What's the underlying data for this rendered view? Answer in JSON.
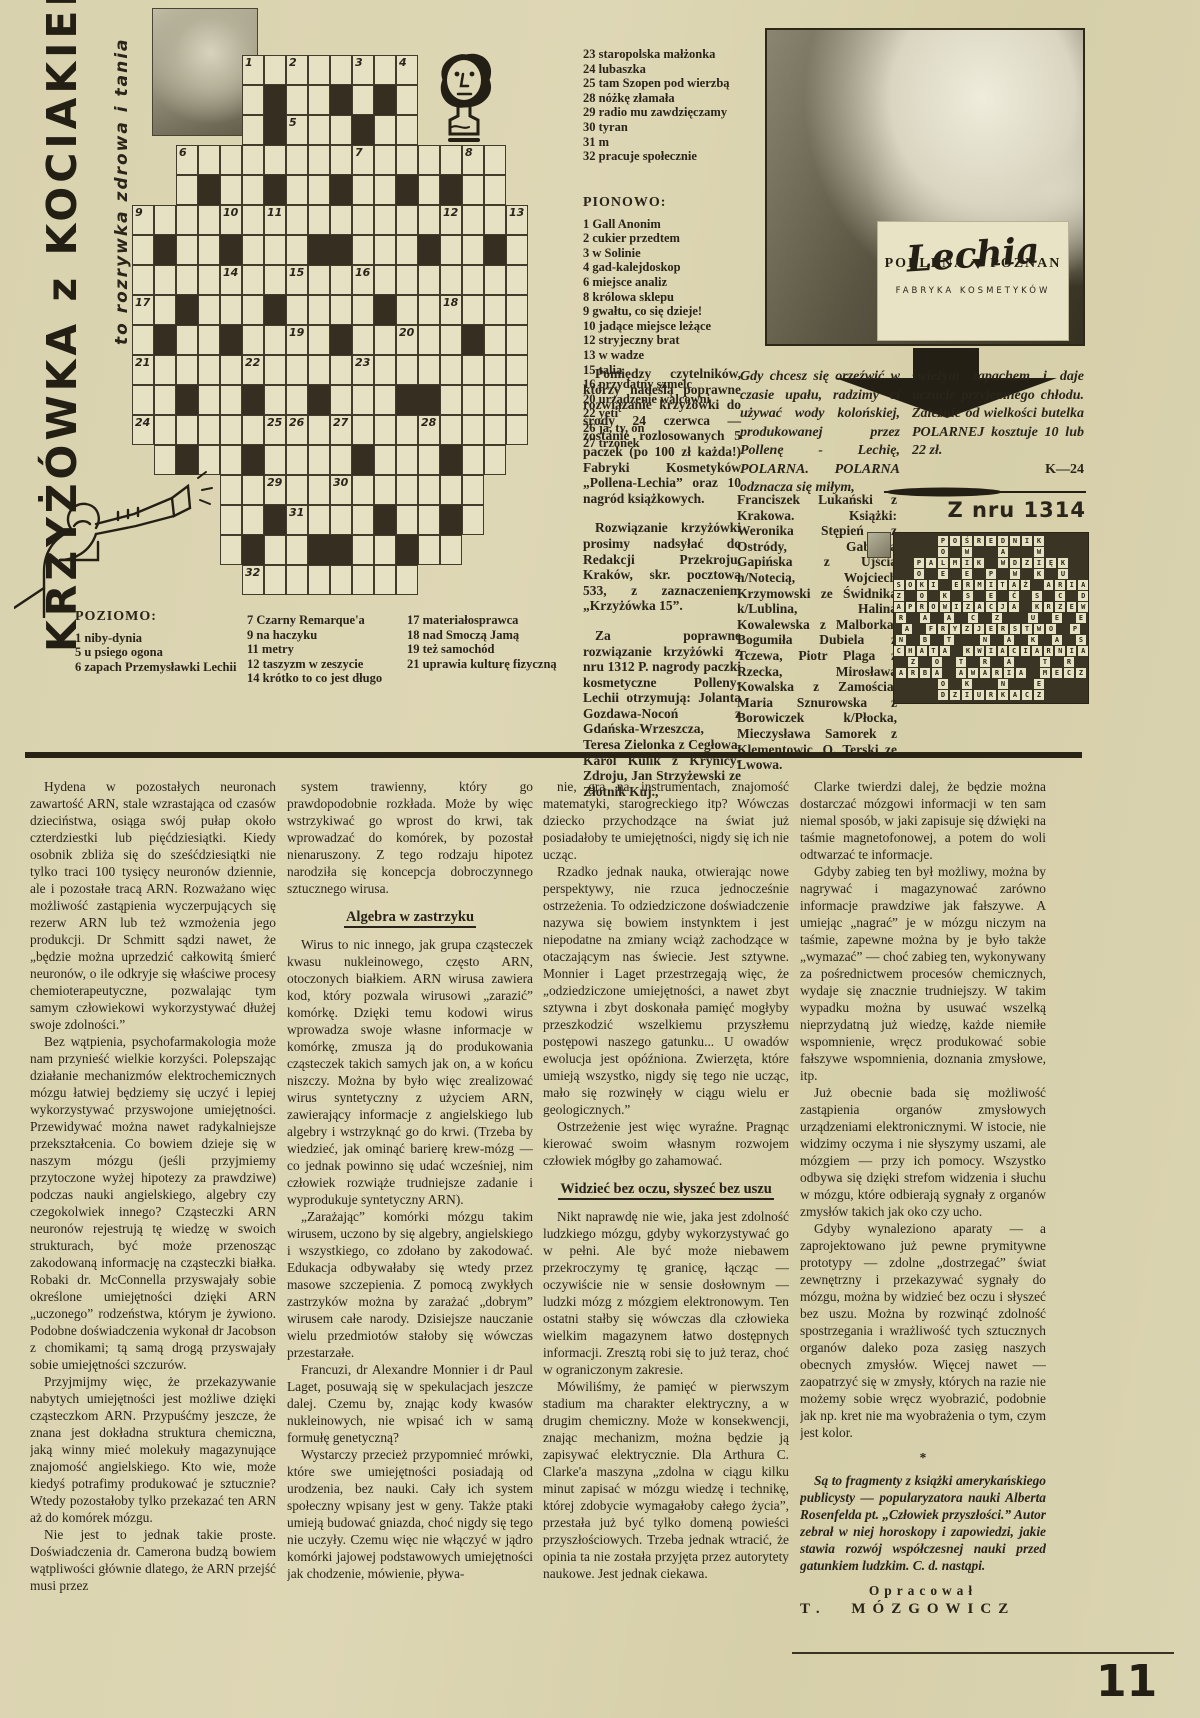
{
  "page": {
    "number": "11"
  },
  "masthead": {
    "title": "KRZYŻÓWKA z KOCIAKIEM",
    "subtitle": "to rozrywka zdrowa i tania"
  },
  "crossword": {
    "grid": [
      ".....wwwwwwww.....",
      ".....wbwwbwbw.....",
      ".....wbwwwbww.....",
      "..wwwwwwwwwwwwwww.",
      "..wbwwbwwbwwbwbww.",
      "wwwwwwwwwwwwwwwwww",
      "wbwwbwwwbbwwwbwwbw",
      "wwwwwwwwwwwwwwwwww",
      "wwbwwwbwwwwbwwwwww",
      "wbwwbwwwwbwwwwwbww",
      "wwwwwwwwwwwwwwwwww",
      "wwbwwbwwbwwwbbwwww",
      "wwwwwwwwwwwwwwwwww",
      ".wbwwbwwwwbwwwbww.",
      "....wwwwwwwwwwww..",
      "....wwbwwwwbwwbw..",
      "....wbwwbbwwbww...",
      ".....wwwwwwww....."
    ],
    "numbers": {
      "0,5": "1",
      "0,7": "2",
      "0,10": "3",
      "0,12": "4",
      "2,7": "5",
      "3,2": "6",
      "3,10": "7",
      "3,15": "8",
      "5,0": "9",
      "5,4": "10",
      "5,6": "11",
      "5,14": "12",
      "5,17": "13",
      "7,4": "14",
      "7,7": "15",
      "7,10": "16",
      "8,0": "17",
      "8,14": "18",
      "9,7": "19",
      "9,12": "20",
      "10,0": "21",
      "10,5": "22",
      "10,10": "23",
      "12,0": "24",
      "12,6": "25",
      "12,7": "26",
      "12,9": "27",
      "12,13": "28",
      "14,6": "29",
      "14,9": "30",
      "15,7": "31",
      "17,5": "32"
    }
  },
  "clues": {
    "poziomo_cont": [
      "23 staropolska małżonka",
      "24 lubaszka",
      "25 tam Szopen pod wierzbą",
      "28 nóżkę złamała",
      "29 radio mu zawdzięczamy",
      "30 tyran",
      "31 m",
      "32 pracuje społecznie"
    ],
    "pionowo_label": "PIONOWO:",
    "pionowo": [
      "1 Gall Anonim",
      "2 cukier przedtem",
      "3 w Solinie",
      "4 gad-kalejdoskop",
      "6 miejsce analiz",
      "8 królowa sklepu",
      "9 gwałtu, co się dzieje!",
      "10 jadące miejsce leżące",
      "12 stryjeczny brat",
      "13 w wadze",
      "15 talia",
      "16 przydatny szmelc",
      "20 urządzenie walcowni",
      "22 yeti",
      "26 ja, ty, on",
      "27 trzonek"
    ],
    "poziomo_label": "POZIOMO:",
    "poziomo_a": [
      "1 niby-dynia",
      "5 u psiego ogona",
      "6 zapach Przemysławki Lechii"
    ],
    "poziomo_b": [
      "7 Czarny Remarque'a",
      "9 na haczyku",
      "11 metry",
      "12 taszyzm w zeszycie",
      "14 krótko to co jest długo"
    ],
    "poziomo_c": [
      "17 materiałosprawca",
      "18 nad Smoczą Jamą",
      "19 też samochód",
      "21 uprawia kulturę fizyczną"
    ]
  },
  "contest": {
    "p1": "Pomiędzy czytelników, którzy nadeślą poprawne rozwiązanie krzyżówki do środy 24 czerwca — zostanie rozlosowanych 5 paczek (po 100 zł każda!) Fabryki Kosmetyków „Pollena-Lechia” oraz 10 nagród książkowych.",
    "p2": "Rozwiązanie krzyżówki prosimy nadsyłać do Redakcji Przekroju, Kraków, skr. pocztowa 533, z zaznaczeniem „Krzyżówka 15”.",
    "p3": "Za poprawne rozwiązanie krzyżówki z nru 1312 P. nagrody paczki kosmetyczne Polleny-Lechii otrzymują: Jolanta Gozdawa-Nocoń z Gdańska-Wrzeszcza, Teresa Zielonka z Cegłowa, Karol Kulik z Krynicy-Zdroju, Jan Strzyżewski ze Złotnik Kuj.,"
  },
  "ad": {
    "brand_left": "POLLENA",
    "brand_right": "POZNAN",
    "brand_script": "Lechia",
    "brand_sub": "FABRYKA KOSMETYKÓW",
    "text_left": "Gdy chcesz się orzeźwić w czasie upału, radzimy ci używać wody kolońskiej, produkowanej przez Pollenę - Lechię, POLARNA. POLARNA odznacza się miłym,",
    "text_right": "świeżym zapachem i daje uczucie przyjemnego chłodu. Zależnie od wielkości butelka POLARNEJ kosztuje 10 lub 22 zł.",
    "code": "K—24"
  },
  "solution": {
    "heading": "Z nru 1314",
    "rows": [
      "POŚREDNIK",
      "O W  A  W",
      "PALMIK WDZIĘK",
      "O E E P W K U",
      "SOKI ERMITAŻ ARIA",
      "Z O K S E Ć S C D",
      "APROWIZACJA KRZEW",
      "R A A C Z  U E E",
      "A FRYZJERSTWO P",
      "N B T  N A K A S",
      "CHATA KWIACIARNIA",
      "Z O T R A  T R",
      "ARBA AWARIA MECZ",
      "O K  N  E",
      "DZIURKACZ"
    ],
    "winners": "Franciszek Lukański z Krakowa. Książki: Weronika Stępień z Ostródy, Gabriela Gapińska z Ujścia n/Notecią, Wojciech Krzymowski ze Świdnika k/Lublina, Halina Kowalewska z Malborka, Bogumiła Dubiela z Tczewa, Piotr Plaga z Rzecka, Mirosława Kowalska z Zamościa, Maria Sznurowska z Borowiczek k/Płocka, Mieczysława Samorek z Klementowic, O. Terski ze Lwowa."
  },
  "article": {
    "columns": [
      [
        {
          "t": "p",
          "x": "Hydena w pozostałych neuronach zawartość ARN, stale wzrastająca od czasów dzieciństwa, osiąga swój pułap około czterdziestki lub pięćdziesiątki. Kiedy osobnik zbliża się do sześćdziesiątki nie tylko traci 100 tysięcy neuronów dziennie, ale i pozostałe tracą ARN. Rozważano więc możliwość zastąpienia wyczerpujących się rezerw ARN lub też wzmożenia jego produkcji. Dr Schmitt sądzi nawet, że „będzie można uprzedzić całkowitą śmierć neuronów, o ile odkryje się właściwe procesy chemioterapeutyczne, pozwalając tym samym człowiekowi wykorzystywać dłużej swoje zdolności.”"
        },
        {
          "t": "p",
          "x": "Bez wątpienia, psychofarmakologia może nam przynieść wielkie korzyści. Polepszając działanie mechanizmów elektrochemicznych mózgu łatwiej będziemy się uczyć i lepiej wykorzystywać przyswojone umiejętności. Przewidywać można nawet radykalniejsze przekształcenia. Co bowiem dzieje się w naszym mózgu (jeśli przyjmiemy przytoczone wyżej hipotezy za prawdziwe) podczas nauki angielskiego, algebry czy czegokolwiek innego? Cząsteczki ARN neuronów rejestrują tę wiedzę w swoich strukturach, być może przenosząc zakodowaną informację na cząsteczki białka. Robaki dr. McConnella przyswajały sobie określone umiejętności dzięki ARN „uczonego” rodzeństwa, którym je żywiono. Podobne doświadczenia wykonał dr Jacobson z chomikami; tą samą drogą przyswajały sobie umiejętności szczurów."
        },
        {
          "t": "p",
          "x": "Przyjmijmy więc, że przekazywanie nabytych umiejętności jest możliwe dzięki cząsteczkom ARN. Przypuśćmy jeszcze, że znana jest dokładna struktura chemiczna, jaką winny mieć molekuły magazynujące znajomość angielskiego. Kto wie, może kiedyś potrafimy produkować je sztucznie? Wtedy pozostałoby tylko przekazać ten ARN aż do komórek mózgu."
        },
        {
          "t": "p",
          "x": "Nie jest to jednak takie proste. Doświadczenia dr. Camerona budzą bowiem wątpliwości głównie dlatego, że ARN przejść musi przez"
        }
      ],
      [
        {
          "t": "p",
          "x": "system trawienny, który go prawdopodobnie rozkłada. Może by więc wstrzykiwać go wprost do krwi, tak wprowadzać do komórek, by pozostał nienaruszony. Z tego rodzaju hipotez narodziła się koncepcja dobroczynnego sztucznego wirusa."
        },
        {
          "t": "h",
          "x": "Algebra w zastrzyku"
        },
        {
          "t": "p",
          "x": "Wirus to nic innego, jak grupa cząsteczek kwasu nukleinowego, często ARN, otoczonych białkiem. ARN wirusa zawiera kod, który pozwala wirusowi „zarazić” komórkę. Dzięki temu kodowi wirus wprowadza swoje własne informacje w komórkę, zmusza ją do produkowania cząsteczek takich samych jak on, a w końcu niszczy. Można by było więc zrealizować wirus syntetyczny z użyciem ARN, zawierający informacje z angielskiego lub algebry i wstrzyknąć go do krwi. (Trzeba by wiedzieć, jak ominąć barierę krew-mózg — co jednak powinno się udać wcześniej, nim człowiek rozwiąże trudniejsze zadanie i wyprodukuje syntetyczny ARN)."
        },
        {
          "t": "p",
          "x": "„Zarażając” komórki mózgu takim wirusem, uczono by się algebry, angielskiego i wszystkiego, co zdołano by zakodować. Edukacja odbywałaby się wtedy przez masowe szczepienia. Z pomocą zwykłych zastrzyków można by zarażać „dobrym” wirusem całe narody. Dzisiejsze nauczanie wielu przedmiotów stałoby się wówczas przestarzałe."
        },
        {
          "t": "p",
          "x": "Francuzi, dr Alexandre Monnier i dr Paul Laget, posuwają się w spekulacjach jeszcze dalej. Czemu by, znając kody kwasów nukleinowych, nie wpisać ich w samą formułę genetyczną?"
        },
        {
          "t": "p",
          "x": "Wystarczy przecież przypomnieć mrówki, które swe umiejętności posiadają od urodzenia, bez nauki. Cały ich system społeczny wpisany jest w geny. Także ptaki umieją budować gniazda, choć nigdy się tego nie uczyły. Czemu więc nie włączyć w jądro komórki jajowej podstawowych umiejętności jak chodzenie, mówienie, pływa-"
        }
      ],
      [
        {
          "t": "p",
          "x": "nie, gra na instrumentach, znajomość matematyki, starogreckiego itp? Wówczas dziecko przychodzące na świat już posiadałoby te umiejętności, nigdy się ich nie ucząc."
        },
        {
          "t": "p",
          "x": "Rzadko jednak nauka, otwierając nowe perspektywy, nie rzuca jednocześnie ostrzeżenia. To odziedziczone doświadczenie nazywa się bowiem instynktem i jest niepodatne na zmiany wciąż zachodzące w otaczającym nas świecie. Jest sztywne. Monnier i Laget przestrzegają więc, że „odziedziczone umiejętności, a nawet zbyt sztywna i zbyt doskonała pamięć mogłyby przeszkodzić wszelkiemu przyszłemu postępowi naszego gatunku... U owadów ewolucja jest opóźniona. Zwierzęta, które umieją wszystko, nigdy się tego nie ucząc, mało się rozwinęły w ciągu wielu er geologicznych.”"
        },
        {
          "t": "p",
          "x": "Ostrzeżenie jest więc wyraźne. Pragnąc kierować swoim własnym rozwojem człowiek mógłby go zahamować."
        },
        {
          "t": "h",
          "x": "Widzieć bez oczu, słyszeć bez uszu"
        },
        {
          "t": "p",
          "x": "Nikt naprawdę nie wie, jaka jest zdolność ludzkiego mózgu, gdyby wykorzystywać go w pełni. Ale być może niebawem przekroczymy tę granicę, łącząc — oczywiście nie w sensie dosłownym — ludzki mózg z mózgiem elektronowym. Ten ostatni stałby się wówczas dla człowieka wielkim magazynem łatwo dostępnych informacji. Zresztą robi się to już teraz, choć w ograniczonym zakresie."
        },
        {
          "t": "p",
          "x": "Mówiliśmy, że pamięć w pierwszym stadium ma charakter elektryczny, a w drugim chemiczny. Może w konsekwencji, znając mechanizm, można będzie ją zapisywać elektrycznie. Dla Arthura C. Clarke'a maszyna „zdolna w ciągu kilku minut zapisać w mózgu wiedzę i technikę, której zdobycie wymagałoby całego życia”, przestała już być tylko domeną powieści przyszłościowych. Trzeba jednak wtracić, że opinia ta nie została przyjęta przez autorytety naukowe. Jest jednak ciekawa."
        }
      ],
      [
        {
          "t": "p",
          "x": "Clarke twierdzi dalej, że będzie można dostarczać mózgowi informacji w ten sam niemal sposób, w jaki zapisuje się dźwięki na taśmie magnetofonowej, a potem do woli odtwarzać te informacje."
        },
        {
          "t": "p",
          "x": "Gdyby zabieg ten był możliwy, można by nagrywać i magazynować zarówno informacje prawdziwe jak fałszywe. A umiejąc „nagrać” je w mózgu niczym na taśmie, zapewne można by je było także „wymazać” — choć zabieg ten, wykonywany za pośrednictwem procesów chemicznych, wydaje się znacznie trudniejszy. W takim wypadku można by usuwać wszelką nieprzydatną już wiedzę, każde niemiłe wspomnienie, wręcz produkować sobie fałszywe wspomnienia, doznania zmysłowe, itp."
        },
        {
          "t": "p",
          "x": "Już obecnie bada się możliwość zastąpienia organów zmysłowych urządzeniami elektronicznymi. W istocie, nie widzimy oczyma i nie słyszymy uszami, ale mózgiem — przy ich pomocy. Wszystko odbywa się dzięki strefom widzenia i słuchu w mózgu, które odbierają sygnały z organów zmysłów takich jak oko czy ucho."
        },
        {
          "t": "p",
          "x": "Gdyby wynaleziono aparaty — a zaprojektowano już pewne prymitywne prototypy — zdolne „dostrzegać” świat zewnętrzny i przekazywać sygnały do mózgu, można by widzieć bez oczu i słyszeć bez uszu. Można by rozwinąć zdolność spostrzegania i wrażliwość tych sztucznych organów daleko poza zasięg naszych obecnych zmysłów. Więcej nawet — zaopatrzyć się w zmysły, których na razie nie możemy sobie wręcz wyobrazić, podobnie jak np. kret nie ma wyobrażenia o tym, czym jest kolor."
        },
        {
          "t": "s",
          "x": "*"
        },
        {
          "t": "i",
          "x": "Są to fragmenty z książki amerykańskiego publicysty — popularyzatora nauki Alberta Rosenfelda pt. „Człowiek przyszłości.” Autor zebrał w niej horoskopy i zapowiedzi, jakie stawia rozwój współczesnej nauki przed gatunkiem ludzkim. C. d. nastąpi."
        },
        {
          "t": "cl",
          "x": "Opracował"
        },
        {
          "t": "cn",
          "x": "T. MÓZGOWICZ"
        }
      ]
    ]
  }
}
